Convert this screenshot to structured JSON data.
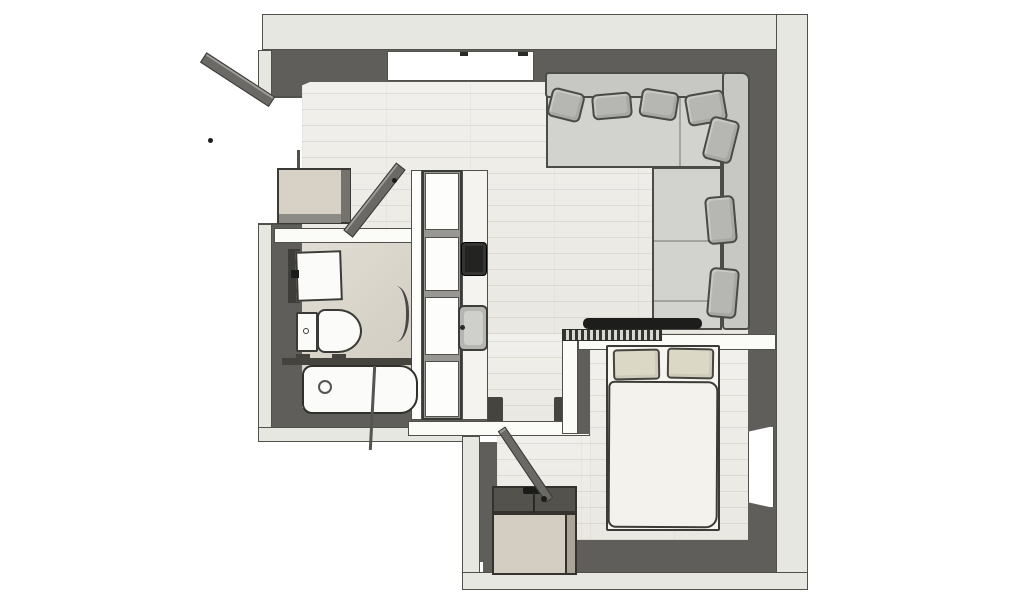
{
  "plan": {
    "view": "top-down 3D floor plan of a one-bedroom apartment",
    "rooms": [
      {
        "id": "living-room",
        "features": [
          "top-window",
          "corner-sofa",
          "sofa-pillows",
          "tv-console",
          "radiator-grille",
          "kitchenette-shelf-column",
          "cooktop",
          "kitchen-sink"
        ]
      },
      {
        "id": "bathroom",
        "features": [
          "vanity-mirror-sink",
          "toilet",
          "glass-shelf",
          "bathtub",
          "shower-screen",
          "curved-glass-door"
        ]
      },
      {
        "id": "bedroom",
        "features": [
          "headboard-wall",
          "double-bed",
          "two-bed-pillows",
          "duvet",
          "side-window",
          "wardrobe-chest",
          "entry-door"
        ]
      },
      {
        "id": "entry-hall",
        "features": [
          "front-door-open-outward",
          "entry-cabinet",
          "bathroom-door-open"
        ]
      }
    ]
  },
  "colors": {
    "wall_outer": "#e7e7e2",
    "wall_face": "#5f5e5a",
    "wall_face_dark": "#4c4b47",
    "wall_edge": "#51514c",
    "floor_wood": "#f1f0ec",
    "floor_bath": "#d7d2c6",
    "sofa": "#c7c7c3",
    "sofa_seat": "#d2d2ce",
    "sofa_pillow": "#b6b6b2",
    "bed_duvet": "#f3f2ec",
    "bed_pillow": "#dcd8c6",
    "cabinet_beige": "#d8d2c6",
    "door_leaf": "#6a6965",
    "tv": "#1d1d1b",
    "fixture_white": "#fbfbf9",
    "sink_grey": "#b5b5b1",
    "cooktop": "#232321",
    "box_top": "#53524d",
    "box_front": "#d4cec2"
  }
}
